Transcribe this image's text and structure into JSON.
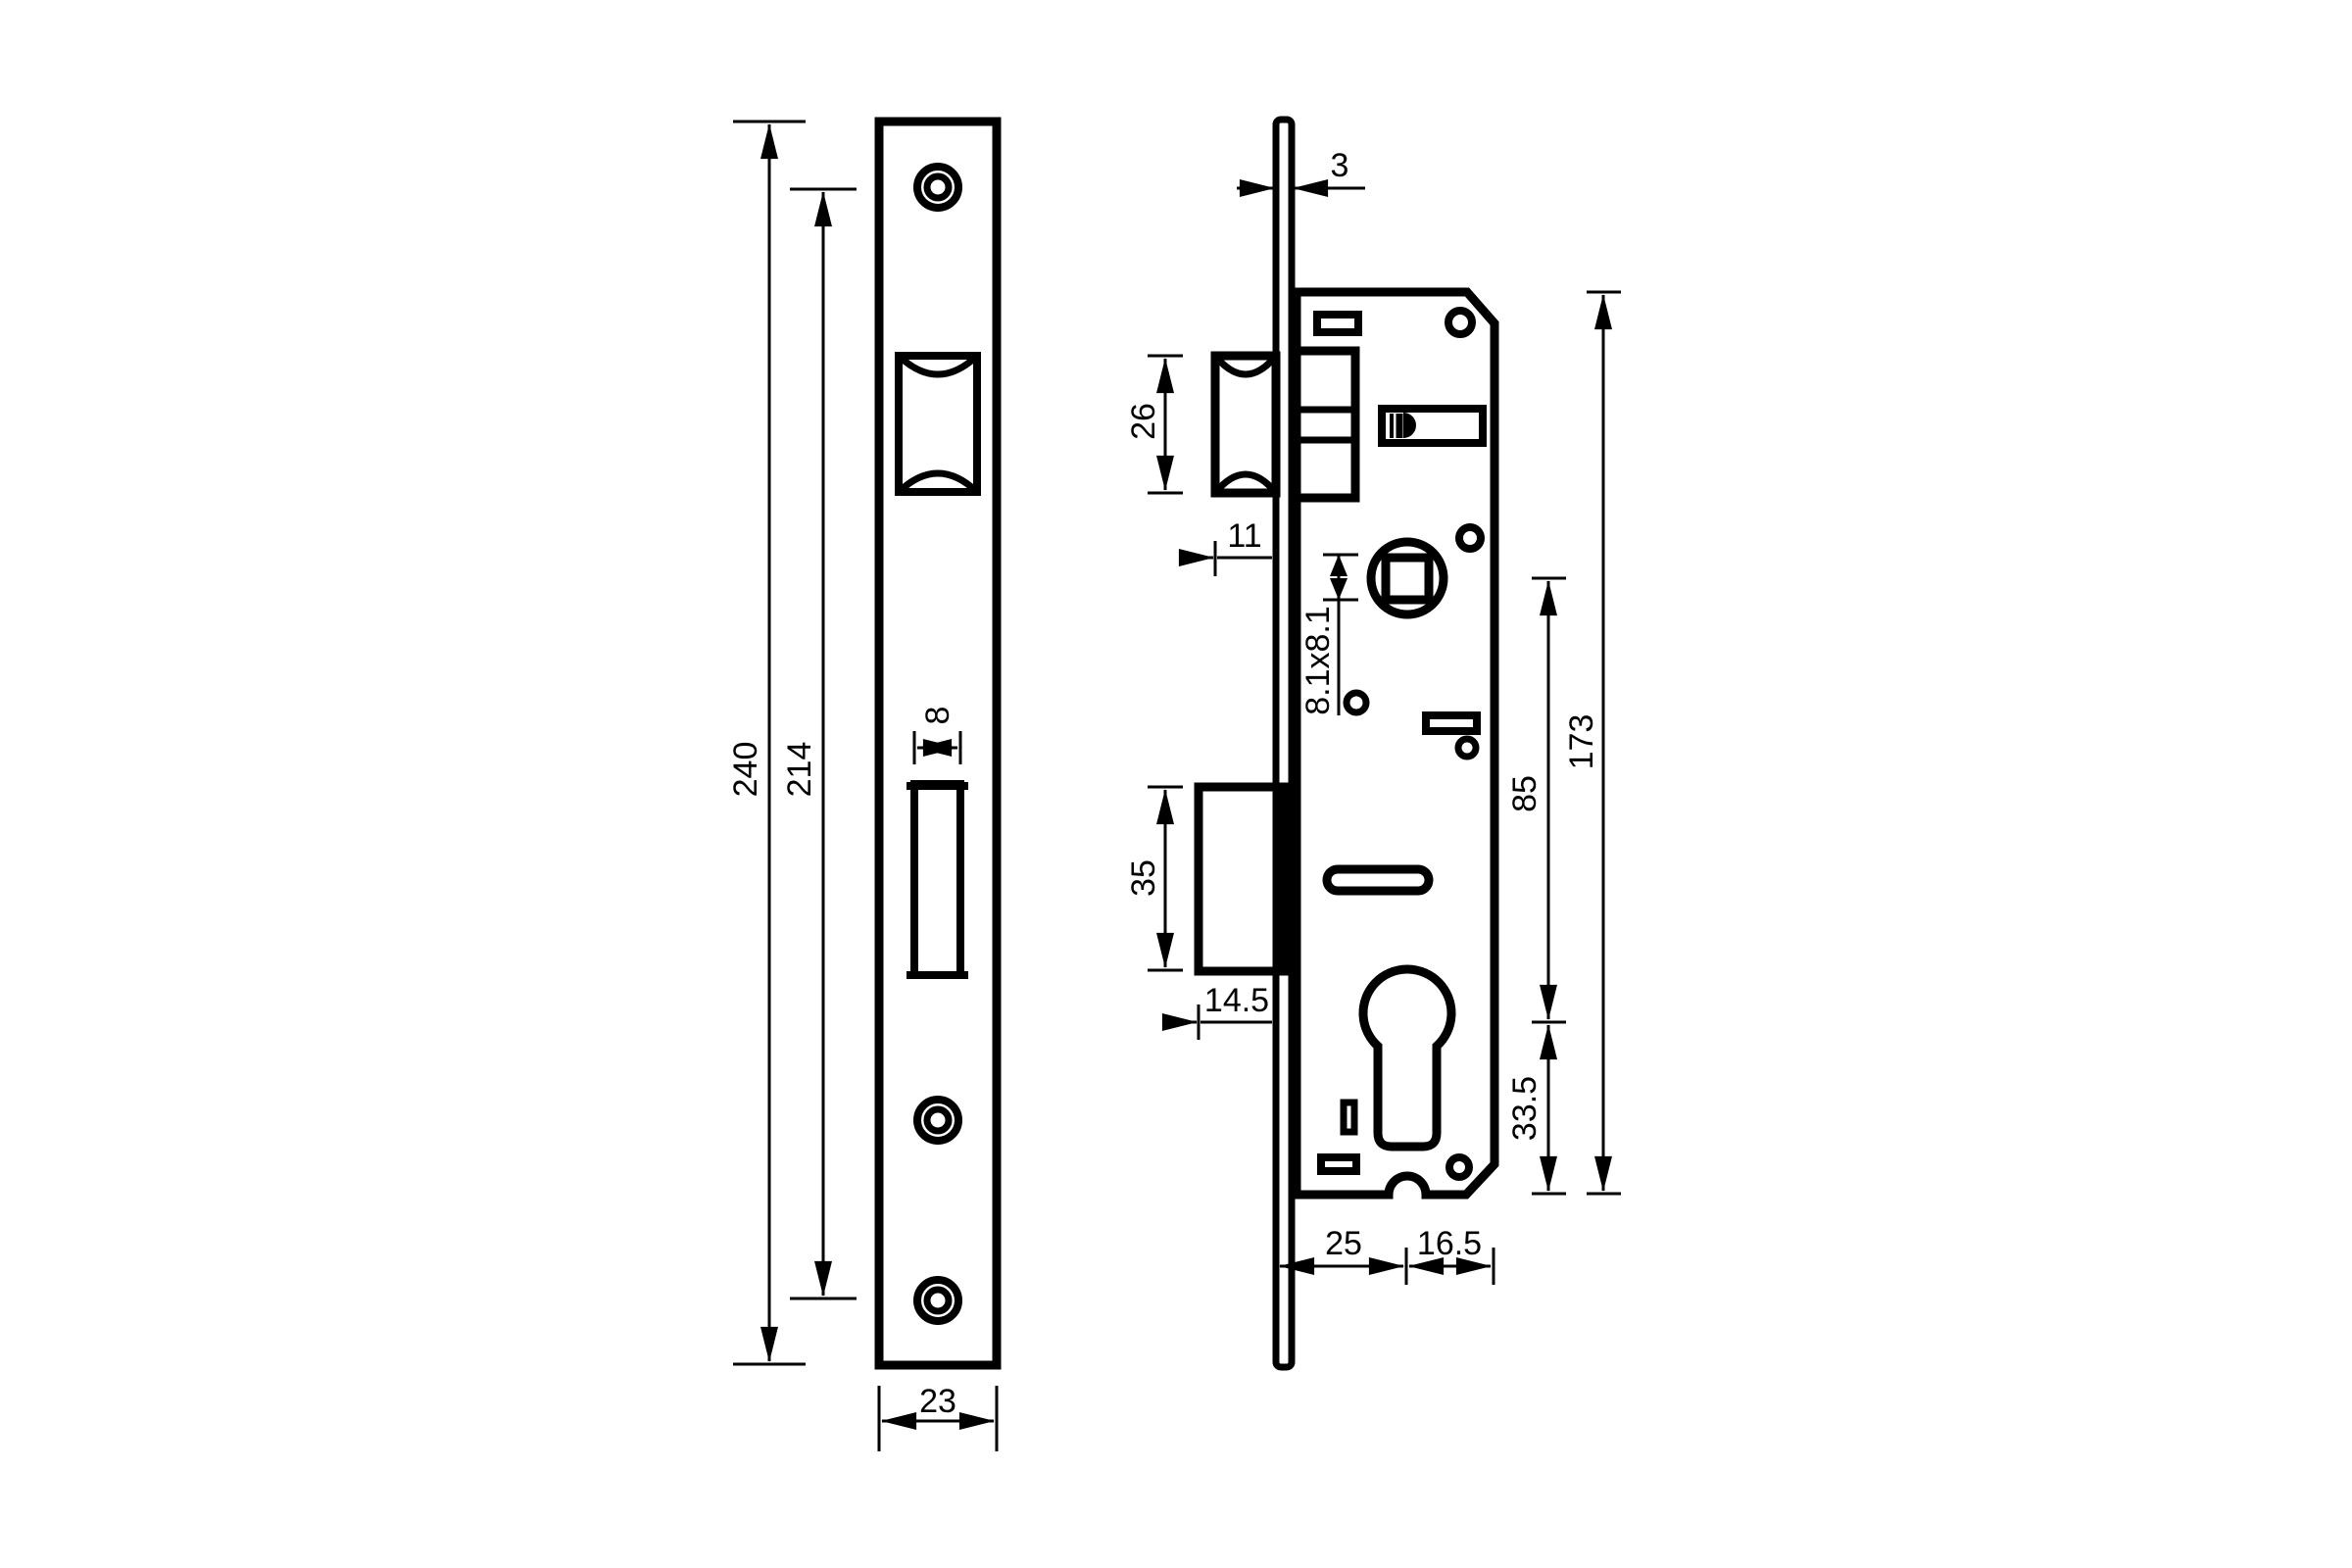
{
  "drawing": {
    "type": "mortise-lock-technical-drawing",
    "background": "#ffffff",
    "line_color": "#000000",
    "front_view": {
      "name": "faceplate-front-view",
      "labels": {
        "overall_height": "240",
        "hole_spacing": "214",
        "slot_width": "8",
        "plate_width": "23"
      }
    },
    "side_view": {
      "name": "lock-body-side-view",
      "labels": {
        "plate_thickness": "3",
        "latch_height": "26",
        "latch_projection": "11",
        "spindle_square": "8.1x8.1",
        "bolt_height": "35",
        "bolt_projection": "14.5",
        "axis_distance": "85",
        "body_height": "173",
        "cylinder_to_bottom": "33.5",
        "backset": "25",
        "body_behind_axis": "16.5"
      }
    }
  }
}
